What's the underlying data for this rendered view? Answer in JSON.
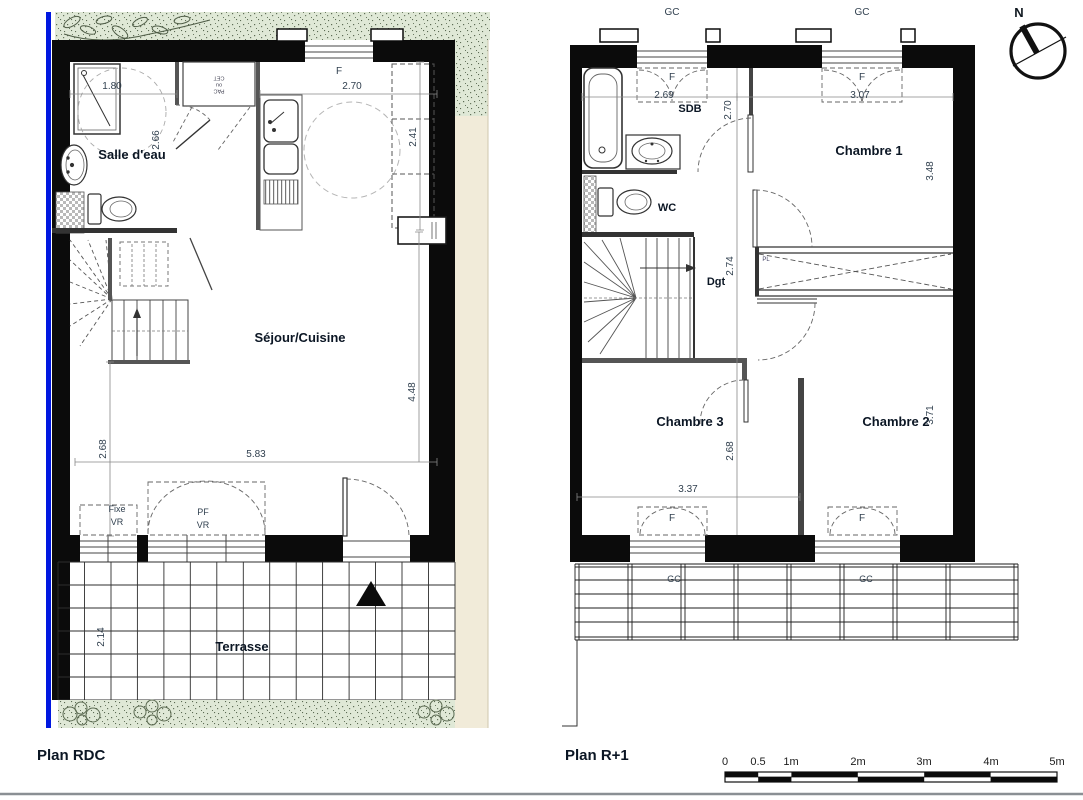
{
  "rdc": {
    "title": "Plan RDC",
    "room_salle_deau": "Salle d'eau",
    "room_sejour": "Séjour/Cuisine",
    "room_terrasse": "Terrasse",
    "closet_note": "PAC ou CET",
    "dim_1_80": "1.80",
    "dim_2_66": "2.66",
    "dim_2_70": "2.70",
    "dim_2_41": "2.41",
    "dim_4_48": "4.48",
    "dim_5_83": "5.83",
    "dim_2_68": "2.68",
    "dim_2_14": "2.14",
    "win_f": "F",
    "win_fixe": "Fixe",
    "win_fixe_vr": "VR",
    "win_pf": "PF",
    "win_pf_vr": "VR"
  },
  "r1": {
    "title": "Plan R+1",
    "room_sdb": "SDB",
    "room_wc": "WC",
    "room_dgt": "Dgt",
    "room_ch1": "Chambre 1",
    "room_ch2": "Chambre 2",
    "room_ch3": "Chambre 3",
    "closet_pl": "PL",
    "dim_2_69": "2.69",
    "dim_3_07": "3.07",
    "dim_2_70": "2.70",
    "dim_3_48": "3.48",
    "dim_2_74": "2.74",
    "dim_2_68": "2.68",
    "dim_3_37": "3.37",
    "dim_3_71": "3.71",
    "gc": "GC",
    "win_f": "F"
  },
  "compass": {
    "north_label": "N"
  },
  "scalebar": {
    "labels": [
      "0",
      "0.5",
      "1m",
      "2m",
      "3m",
      "4m",
      "5m"
    ]
  },
  "colors": {
    "wall": "#0b0b0b",
    "property_line": "#0018e0",
    "vegetation_fill": "#dfe8d6",
    "path_fill": "#f1ebd9",
    "dim_text": "#31404f",
    "room_text": "#0b1624"
  }
}
